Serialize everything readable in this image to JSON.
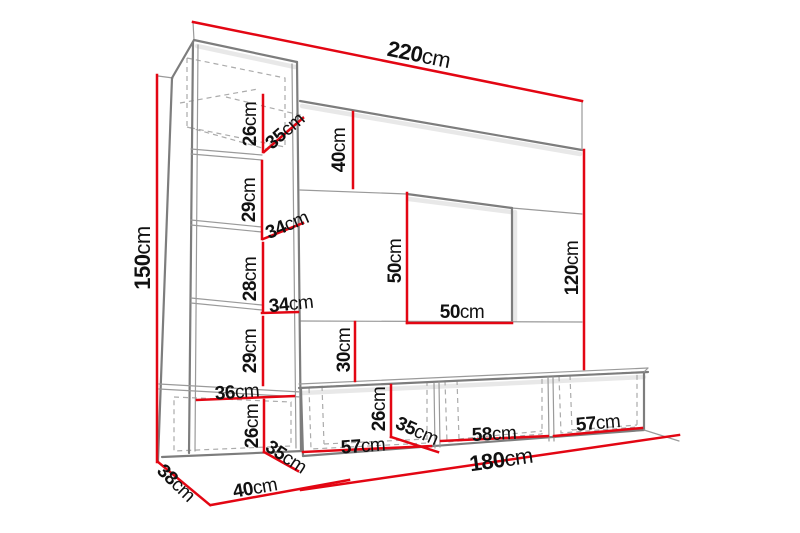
{
  "unit": "cm",
  "colors": {
    "dimension": "#e30613",
    "structure": "#7d7d7d",
    "structure_light": "#9a9a9a",
    "dashed": "#ababab",
    "text": "#111111",
    "background": "#ffffff"
  },
  "dims": {
    "width_total": {
      "num": "220",
      "unit": "cm"
    },
    "height_left_column": {
      "num": "150",
      "unit": "cm"
    },
    "top_cabinet_height": {
      "num": "26",
      "unit": "cm"
    },
    "top_cabinet_depth": {
      "num": "35",
      "unit": "cm"
    },
    "panel_top_section_height": {
      "num": "40",
      "unit": "cm"
    },
    "shelf_gap_upper": {
      "num": "29",
      "unit": "cm"
    },
    "shelf_depth_upper": {
      "num": "34",
      "unit": "cm"
    },
    "shelf_gap_middle": {
      "num": "28",
      "unit": "cm"
    },
    "shelf_depth_lower": {
      "num": "34",
      "unit": "cm"
    },
    "shelf_gap_lower": {
      "num": "29",
      "unit": "cm"
    },
    "tv_niche_height": {
      "num": "50",
      "unit": "cm"
    },
    "tv_niche_width": {
      "num": "50",
      "unit": "cm"
    },
    "height_right_panel": {
      "num": "120",
      "unit": "cm"
    },
    "gap_panel_to_stand": {
      "num": "30",
      "unit": "cm"
    },
    "base_cabinet_inner_width": {
      "num": "36",
      "unit": "cm"
    },
    "base_cabinet_height": {
      "num": "26",
      "unit": "cm"
    },
    "base_cabinet_depth": {
      "num": "35",
      "unit": "cm"
    },
    "stand_height": {
      "num": "26",
      "unit": "cm"
    },
    "stand_depth": {
      "num": "35",
      "unit": "cm"
    },
    "stand_section_left_width": {
      "num": "57",
      "unit": "cm"
    },
    "stand_section_middle_width": {
      "num": "58",
      "unit": "cm"
    },
    "stand_section_right_width": {
      "num": "57",
      "unit": "cm"
    },
    "stand_total_width": {
      "num": "180",
      "unit": "cm"
    },
    "column_floor_depth": {
      "num": "38",
      "unit": "cm"
    },
    "column_floor_width": {
      "num": "40",
      "unit": "cm"
    }
  }
}
